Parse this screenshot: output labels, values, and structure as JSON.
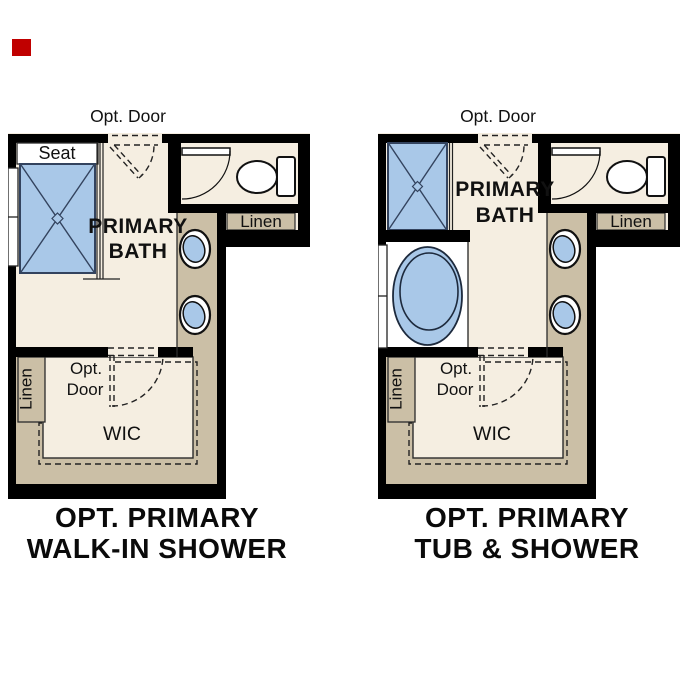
{
  "colors": {
    "wall": "#000000",
    "cream": "#f5eee1",
    "tan": "#cbbfa6",
    "fixture_blue": "#a9c8e8",
    "white": "#ffffff",
    "outline": "#2b2b2b",
    "marker_red": "#c00000"
  },
  "plans": [
    {
      "name": "walk-in shower option",
      "caption_line1": "OPT. PRIMARY",
      "caption_line2": "WALK-IN SHOWER",
      "labels": {
        "opt_door_top": "Opt. Door",
        "seat": "Seat",
        "bath_line1": "PRIMARY",
        "bath_line2": "BATH",
        "linen_upper": "Linen",
        "linen_lower": "Linen",
        "opt_lower_line1": "Opt.",
        "opt_lower_line2": "Door",
        "wic": "WIC"
      }
    },
    {
      "name": "tub and shower option",
      "caption_line1": "OPT. PRIMARY",
      "caption_line2": "TUB & SHOWER",
      "labels": {
        "opt_door_top": "Opt. Door",
        "bath_line1": "PRIMARY",
        "bath_line2": "BATH",
        "linen_upper": "Linen",
        "linen_lower": "Linen",
        "opt_lower_line1": "Opt.",
        "opt_lower_line2": "Door",
        "wic": "WIC"
      }
    }
  ]
}
